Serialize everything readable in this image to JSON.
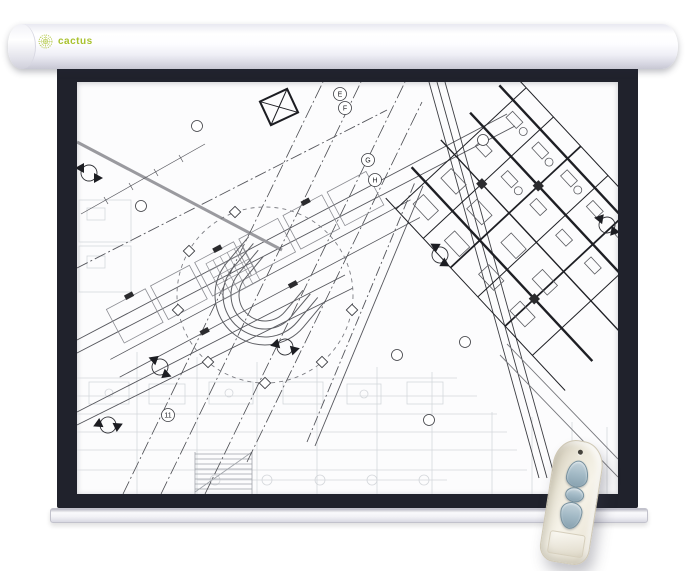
{
  "scene": {
    "background_color": "#ffffff"
  },
  "projector_screen": {
    "brand": {
      "logo_text": "cactus",
      "logo_color": "#a9c22e"
    },
    "casing_color": "#f4f4f8",
    "frame_color": "#20222c",
    "surface_color": "#fcfcfd",
    "slat_color": "#eeeef3"
  },
  "blueprint": {
    "grid_bubble_labels": [
      "E",
      "F",
      "G",
      "H",
      "11"
    ]
  },
  "remote_control": {
    "body_color": "#efece1",
    "button_color": "#9fb7c2",
    "buttons": [
      {
        "name": "up"
      },
      {
        "name": "stop"
      },
      {
        "name": "down"
      }
    ]
  }
}
